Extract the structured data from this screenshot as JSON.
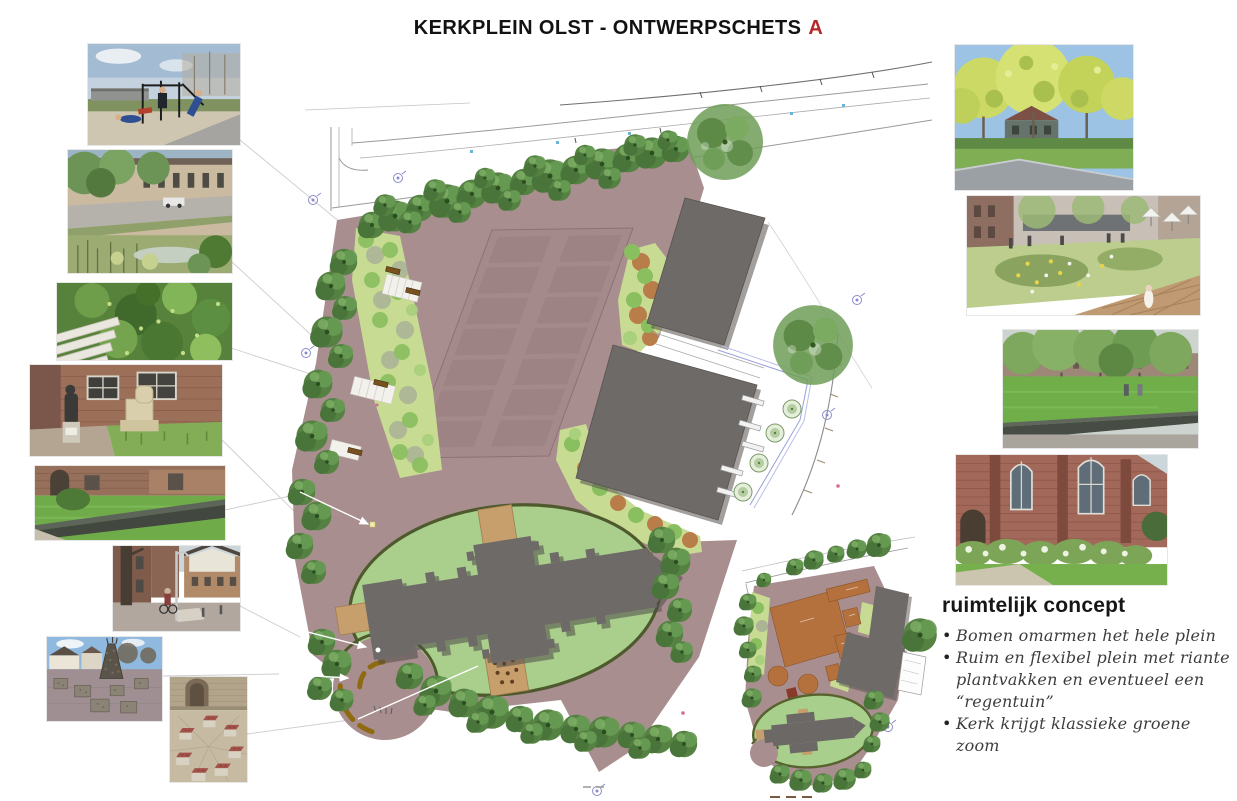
{
  "title": {
    "text": "KERKPLEIN OLST - ONTWERPSCHETS",
    "variant": "A",
    "variant_color": "#b5282a"
  },
  "concept": {
    "heading": "ruimtelijk concept",
    "bullet_char": "•",
    "bullets": [
      "Bomen omarmen het hele plein",
      "Ruim en flexibel plein met riante plantvakken en eventueel een “regentuin”",
      "Kerk krijgt klassieke groene zoom"
    ]
  },
  "plan": {
    "name": "ontwerpschets-plattegrond",
    "colors": {
      "plaza": "#a98e8f",
      "parking_stall": "#8f757a",
      "building": "#6e6a67",
      "church": "#6e6a67",
      "church_lawn": "#aace8c",
      "hedge_border": "#4e5a2d",
      "planting_bed": "#c7db92",
      "bed_circle_green": "#8abf60",
      "bed_circle_orange": "#b97d49",
      "tree": "#558243",
      "entry_paving": "#c79f6d",
      "bench_arc": "#8f6a10",
      "function_area_orange": "#b4713d",
      "survey_symbol": "#8a8acc"
    }
  },
  "photos": {
    "left": [
      {
        "name": "fitness-equipment-photo"
      },
      {
        "name": "street-raingarden-photo"
      },
      {
        "name": "plants-in-paving-photo"
      },
      {
        "name": "statues-photo"
      },
      {
        "name": "church-lawn-edge-photo"
      },
      {
        "name": "street-lamppost-photo"
      },
      {
        "name": "village-square-tower-photo"
      },
      {
        "name": "brick-seat-circle-photo"
      }
    ],
    "right": [
      {
        "name": "street-trees-photo"
      },
      {
        "name": "regentuin-render-photo"
      },
      {
        "name": "green-square-trees-photo"
      },
      {
        "name": "church-hedge-photo"
      }
    ]
  }
}
